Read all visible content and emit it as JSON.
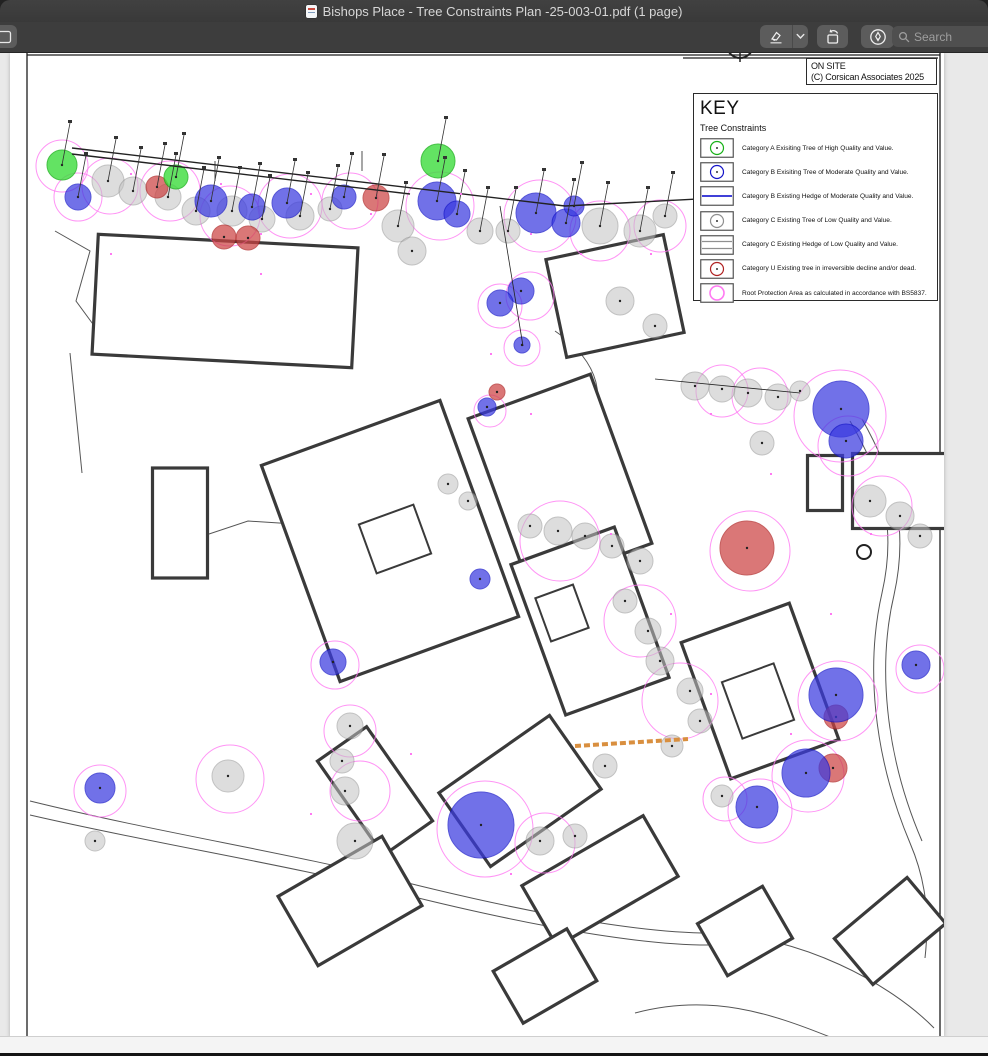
{
  "titlebar": {
    "title": "Bishops Place - Tree Constraints Plan -25-003-01.pdf (1 page)"
  },
  "toolbar": {
    "search_placeholder": "Search"
  },
  "plan": {
    "on_site_line1": "ON SITE",
    "on_site_line2": "(C) Corsican Associates 2025",
    "key_title": "KEY",
    "key_subtitle": "Tree Constraints",
    "legend": [
      {
        "type": "tree",
        "color_key": "catA",
        "label": "Category A Exisiting Tree of High Quality and Value."
      },
      {
        "type": "tree",
        "color_key": "catB",
        "label": "Category B Exisiting Tree of Moderate Quality and Value."
      },
      {
        "type": "hedgeB",
        "color_key": "hedgeB",
        "label": "Category B Existing Hedge of Moderate Quality and Value."
      },
      {
        "type": "tree",
        "color_key": "catC",
        "label": "Category C Existing Tree of Low Quality and Value."
      },
      {
        "type": "hedgeC",
        "color_key": "catC",
        "label": "Category C Existing Hedge of Low Quality and Value."
      },
      {
        "type": "tree",
        "color_key": "catU",
        "label": "Category U Existing tree in irreversible decline and/or dead."
      },
      {
        "type": "rpa",
        "color_key": "rpa",
        "label": "Root Protection Area as calculated in accordance with BS5837."
      }
    ]
  },
  "colors": {
    "catA": "#3ddd3d",
    "catAStroke": "#17b117",
    "catB": "#3b3be0",
    "catBStroke": "#1414c8",
    "catC": "#c2c2c2",
    "catCStroke": "#8f8f8f",
    "catU": "#cc4343",
    "catUStroke": "#b02222",
    "rpa": "#ff79f2",
    "hedgeB": "#0000cc",
    "wall": "#3a3a3a",
    "road": "#555555",
    "survey": "#222222",
    "dash": "#d98f3f"
  },
  "map": {
    "frame_lines": [
      [
        17,
        0,
        17,
        985
      ],
      [
        17,
        2,
        930,
        2
      ],
      [
        930,
        0,
        930,
        985
      ],
      [
        673,
        5,
        928,
        5
      ]
    ],
    "survey_heavy": [
      [
        62,
        95,
        555,
        153
      ],
      [
        555,
        153,
        895,
        135
      ],
      [
        62,
        101,
        400,
        141
      ]
    ],
    "survey_light": [
      [
        490,
        153,
        513,
        293
      ],
      [
        645,
        326,
        790,
        340
      ],
      [
        352,
        118,
        352,
        98
      ],
      [
        205,
        108,
        205,
        128
      ]
    ],
    "roads": [
      "M20,748 C150,780 280,800 390,828 C470,848 610,880 700,880 C790,882 880,930 924,975",
      "M20,762 C150,792 280,812 388,840 C468,860 608,892 698,892",
      "M840,368 C870,420 888,470 872,540 C856,610 862,700 900,790 C915,825 920,860 915,905",
      "M852,366 C882,420 900,470 884,542 C868,610 874,700 912,788",
      "M545,278 C590,308 600,350 572,380 C552,402 552,420 577,430",
      "M45,178 L80,198 L66,248 L88,278",
      "M60,300 L72,420",
      "M148,498 L238,468 L300,472",
      "M625,960 C700,940 760,960 820,984"
    ],
    "buildings": [
      {
        "cx": 215,
        "cy": 248,
        "w": 260,
        "h": 120,
        "rot": 3
      },
      {
        "cx": 170,
        "cy": 470,
        "w": 55,
        "h": 110,
        "rot": 0
      },
      {
        "cx": 380,
        "cy": 488,
        "w": 190,
        "h": 230,
        "rot": -20
      },
      {
        "cx": 550,
        "cy": 428,
        "w": 130,
        "h": 180,
        "rot": -20
      },
      {
        "cx": 580,
        "cy": 568,
        "w": 110,
        "h": 160,
        "rot": -20
      },
      {
        "cx": 750,
        "cy": 638,
        "w": 115,
        "h": 145,
        "rot": -20
      },
      {
        "cx": 605,
        "cy": 243,
        "w": 120,
        "h": 100,
        "rot": -12
      },
      {
        "cx": 890,
        "cy": 438,
        "w": 95,
        "h": 75,
        "rot": 0
      },
      {
        "cx": 815,
        "cy": 430,
        "w": 35,
        "h": 55,
        "rot": 0
      },
      {
        "cx": 365,
        "cy": 738,
        "w": 60,
        "h": 115,
        "rot": -35
      },
      {
        "cx": 510,
        "cy": 738,
        "w": 135,
        "h": 90,
        "rot": -35
      },
      {
        "cx": 340,
        "cy": 848,
        "w": 120,
        "h": 80,
        "rot": -30
      },
      {
        "cx": 590,
        "cy": 828,
        "w": 140,
        "h": 70,
        "rot": -30
      },
      {
        "cx": 880,
        "cy": 878,
        "w": 95,
        "h": 60,
        "rot": -40
      },
      {
        "cx": 735,
        "cy": 878,
        "w": 75,
        "h": 60,
        "rot": -30
      },
      {
        "cx": 535,
        "cy": 923,
        "w": 85,
        "h": 60,
        "rot": -30
      }
    ],
    "inner_structures": [
      {
        "cx": 385,
        "cy": 486,
        "w": 58,
        "h": 52,
        "rot": -20
      },
      {
        "cx": 748,
        "cy": 648,
        "w": 55,
        "h": 60,
        "rot": -20
      },
      {
        "cx": 552,
        "cy": 560,
        "w": 40,
        "h": 46,
        "rot": -20
      }
    ],
    "rpa": [
      [
        100,
        133,
        28
      ],
      [
        160,
        138,
        30
      ],
      [
        220,
        163,
        30
      ],
      [
        280,
        153,
        32
      ],
      [
        340,
        148,
        28
      ],
      [
        430,
        153,
        34
      ],
      [
        530,
        163,
        36
      ],
      [
        590,
        178,
        30
      ],
      [
        650,
        173,
        26
      ],
      [
        68,
        144,
        24
      ],
      [
        52,
        113,
        26
      ],
      [
        550,
        488,
        40
      ],
      [
        630,
        568,
        36
      ],
      [
        670,
        648,
        38
      ],
      [
        830,
        363,
        46
      ],
      [
        838,
        393,
        30
      ],
      [
        740,
        498,
        40
      ],
      [
        828,
        648,
        40
      ],
      [
        798,
        723,
        36
      ],
      [
        750,
        758,
        32
      ],
      [
        910,
        616,
        24
      ],
      [
        475,
        776,
        48
      ],
      [
        350,
        738,
        30
      ],
      [
        220,
        726,
        34
      ],
      [
        340,
        678,
        26
      ],
      [
        535,
        790,
        30
      ],
      [
        715,
        746,
        22
      ],
      [
        90,
        738,
        26
      ],
      [
        325,
        612,
        24
      ],
      [
        872,
        453,
        30
      ],
      [
        712,
        338,
        26
      ],
      [
        750,
        343,
        28
      ],
      [
        490,
        253,
        22
      ],
      [
        520,
        243,
        24
      ],
      [
        512,
        295,
        18
      ],
      [
        480,
        358,
        16
      ]
    ],
    "trees": {
      "C": [
        [
          98,
          128,
          16
        ],
        [
          123,
          138,
          14
        ],
        [
          158,
          144,
          13
        ],
        [
          186,
          158,
          14
        ],
        [
          222,
          158,
          15
        ],
        [
          252,
          166,
          13
        ],
        [
          290,
          163,
          14
        ],
        [
          320,
          156,
          12
        ],
        [
          388,
          173,
          16
        ],
        [
          402,
          198,
          14
        ],
        [
          470,
          178,
          13
        ],
        [
          498,
          178,
          12
        ],
        [
          590,
          173,
          18
        ],
        [
          630,
          178,
          16
        ],
        [
          655,
          163,
          12
        ],
        [
          610,
          248,
          14
        ],
        [
          645,
          273,
          12
        ],
        [
          685,
          333,
          14
        ],
        [
          712,
          336,
          13
        ],
        [
          738,
          340,
          14
        ],
        [
          768,
          344,
          13
        ],
        [
          790,
          338,
          10
        ],
        [
          520,
          473,
          12
        ],
        [
          548,
          478,
          14
        ],
        [
          575,
          483,
          13
        ],
        [
          602,
          493,
          12
        ],
        [
          630,
          508,
          13
        ],
        [
          615,
          548,
          12
        ],
        [
          638,
          578,
          13
        ],
        [
          650,
          608,
          14
        ],
        [
          680,
          638,
          13
        ],
        [
          690,
          668,
          12
        ],
        [
          662,
          693,
          11
        ],
        [
          860,
          448,
          16
        ],
        [
          890,
          463,
          14
        ],
        [
          910,
          483,
          12
        ],
        [
          340,
          673,
          13
        ],
        [
          332,
          708,
          12
        ],
        [
          335,
          738,
          14
        ],
        [
          218,
          723,
          16
        ],
        [
          345,
          788,
          18
        ],
        [
          530,
          788,
          14
        ],
        [
          565,
          783,
          12
        ],
        [
          712,
          743,
          11
        ],
        [
          752,
          390,
          12
        ],
        [
          595,
          713,
          12
        ],
        [
          438,
          431,
          10
        ],
        [
          458,
          448,
          9
        ],
        [
          85,
          788,
          10
        ]
      ],
      "A": [
        [
          52,
          112,
          15
        ],
        [
          166,
          124,
          12
        ],
        [
          428,
          108,
          17
        ]
      ],
      "B": [
        [
          68,
          144,
          13
        ],
        [
          201,
          148,
          16
        ],
        [
          242,
          154,
          13
        ],
        [
          277,
          150,
          15
        ],
        [
          334,
          144,
          12
        ],
        [
          427,
          148,
          19
        ],
        [
          447,
          161,
          13
        ],
        [
          526,
          160,
          20
        ],
        [
          556,
          170,
          14
        ],
        [
          564,
          153,
          10
        ],
        [
          511,
          238,
          13
        ],
        [
          490,
          250,
          13
        ],
        [
          477,
          354,
          9
        ],
        [
          512,
          292,
          8
        ],
        [
          470,
          526,
          10
        ],
        [
          323,
          609,
          13
        ],
        [
          90,
          735,
          15
        ],
        [
          831,
          356,
          28
        ],
        [
          836,
          388,
          17
        ],
        [
          826,
          642,
          27
        ],
        [
          796,
          720,
          24
        ],
        [
          747,
          754,
          21
        ],
        [
          906,
          612,
          14
        ],
        [
          471,
          772,
          33
        ]
      ],
      "U": [
        [
          147,
          134,
          11
        ],
        [
          214,
          184,
          12
        ],
        [
          238,
          185,
          12
        ],
        [
          366,
          145,
          13
        ],
        [
          487,
          339,
          8
        ],
        [
          737,
          495,
          27
        ],
        [
          826,
          664,
          12
        ],
        [
          823,
          715,
          14
        ]
      ]
    },
    "dots": [
      [
        120,
        120
      ],
      [
        210,
        130
      ],
      [
        300,
        140
      ],
      [
        360,
        160
      ],
      [
        450,
        140
      ],
      [
        520,
        180
      ],
      [
        570,
        200
      ],
      [
        640,
        200
      ],
      [
        100,
        200
      ],
      [
        250,
        220
      ],
      [
        480,
        300
      ],
      [
        520,
        360
      ],
      [
        600,
        480
      ],
      [
        660,
        560
      ],
      [
        700,
        640
      ],
      [
        780,
        680
      ],
      [
        820,
        560
      ],
      [
        860,
        480
      ],
      [
        400,
        700
      ],
      [
        300,
        760
      ],
      [
        500,
        820
      ],
      [
        250,
        180
      ],
      [
        700,
        360
      ],
      [
        760,
        420
      ]
    ],
    "dash_line": [
      565,
      693,
      678,
      686
    ],
    "compass": [
      730,
      -8,
      13
    ],
    "roundabout": [
      854,
      499,
      7
    ]
  }
}
